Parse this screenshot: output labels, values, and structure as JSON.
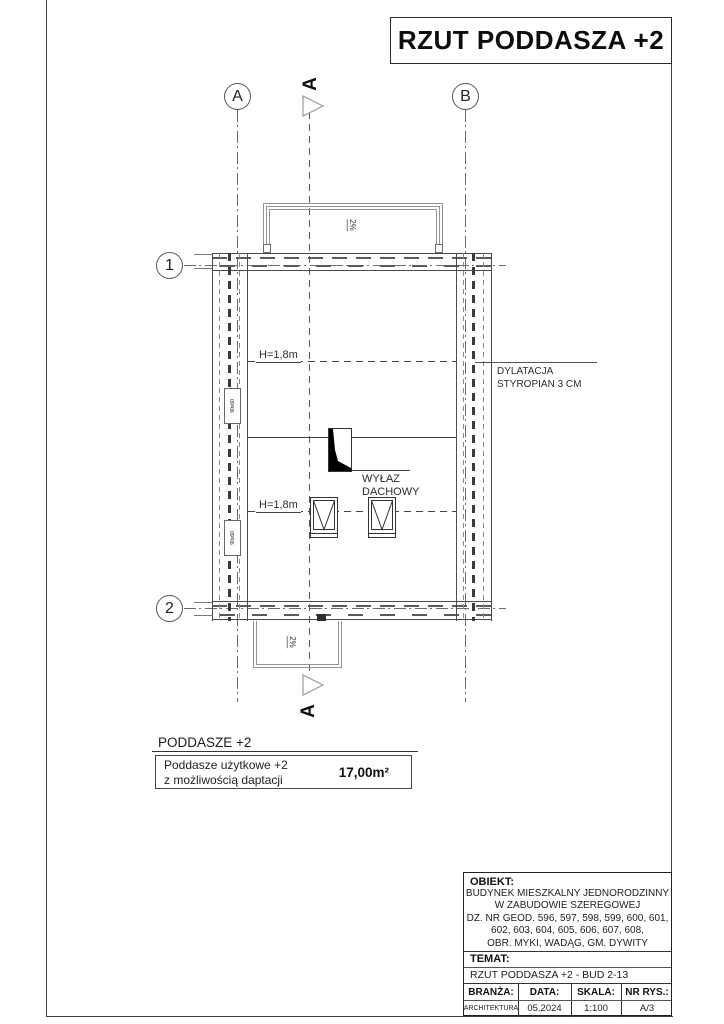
{
  "sheet": {
    "title": "RZUT PODDASZA +2"
  },
  "grid": {
    "axis_a": "A",
    "axis_b": "B",
    "axis_1": "1",
    "axis_2": "2",
    "section_label_top": "A",
    "section_label_bottom": "A"
  },
  "plan": {
    "slope_top": "2%",
    "slope_bottom": "2%",
    "height_line_upper": "H=1,8m",
    "height_line_lower": "H=1,8m",
    "roof_hatch_label_1": "WYŁAZ",
    "roof_hatch_label_2": "DACHOWY",
    "dilatation_label_1": "DYLATACJA",
    "dilatation_label_2": "STYROPIAN 3 CM",
    "window_tag_upper": "90x60",
    "window_tag_lower": "90x60"
  },
  "legend": {
    "header": "PODDASZE +2",
    "item_line1": "Poddasze użytkowe +2",
    "item_line2": "z możliwością daptacji",
    "area": "17,00m²"
  },
  "title_block": {
    "obiekt_label": "OBIEKT:",
    "obiekt_line1": "BUDYNEK MIESZKALNY JEDNORODZINNY",
    "obiekt_line2": "W ZABUDOWIE SZEREGOWEJ",
    "obiekt_line3": "DZ. NR GEOD. 596, 597, 598, 599, 600, 601,",
    "obiekt_line4": "602, 603, 604, 605, 606, 607, 608,",
    "obiekt_line5": "OBR. MYKI, WADĄG, GM. DYWITY",
    "temat_label": "TEMAT:",
    "temat_value": "RZUT PODDASZA +2  - BUD 2-13",
    "branza_label": "BRANŻA:",
    "branza_value": "ARCHITEKTURA",
    "data_label": "DATA:",
    "data_value": "05.2024",
    "skala_label": "SKALA:",
    "skala_value": "1:100",
    "nr_rys_label": "NR RYS.:",
    "nr_rys_value": "A/3"
  },
  "colors": {
    "line_dark": "#3f3f3f",
    "line_light": "#949494",
    "axis": "#6b6b6b"
  }
}
